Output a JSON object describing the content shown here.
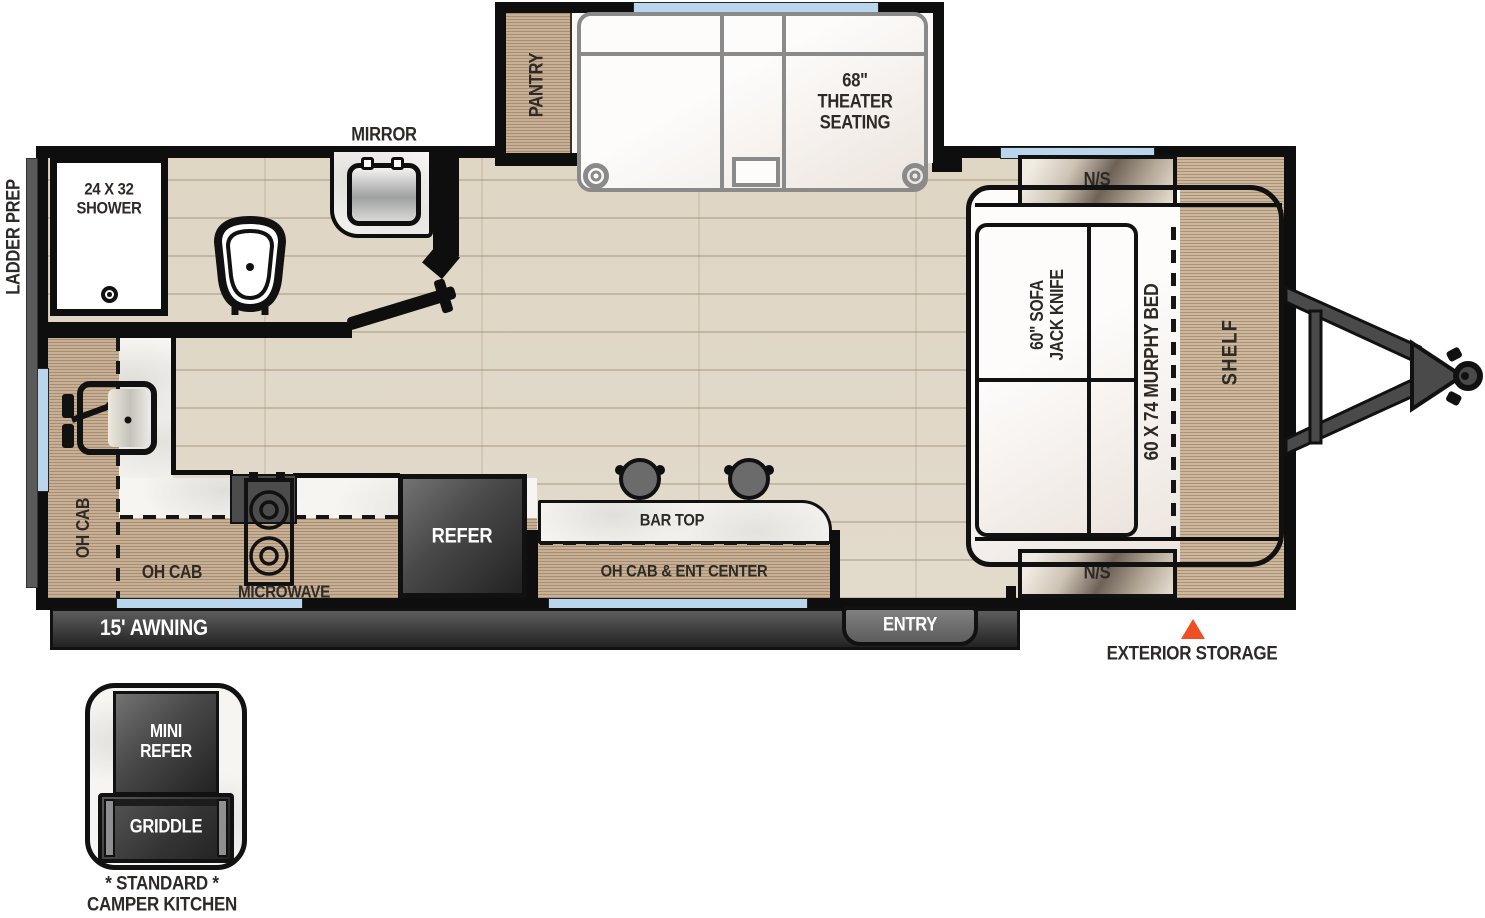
{
  "colors": {
    "wall": "#0E0E0E",
    "floor_wood": "#E2DACB",
    "cabinet_wood": "#C8B096",
    "marble": "#F6F5F2",
    "window_blue": "#B9D6EC",
    "dark_gray": "#4A4A4A",
    "accent_orange": "#F04E23"
  },
  "exterior": {
    "ladder_prep_label": "LADDER PREP",
    "awning_label": "15' AWNING",
    "entry_label": "ENTRY",
    "exterior_storage_label": "EXTERIOR STORAGE"
  },
  "bathroom": {
    "mirror_label": "MIRROR",
    "shower_label": "24 X 32\nSHOWER"
  },
  "slide_out": {
    "pantry_label": "PANTRY",
    "theater_label": "68\"\nTHEATER\nSEATING"
  },
  "kitchen": {
    "oh_cab_left_label": "OH CAB",
    "oh_cab_bottom_label": "OH CAB",
    "microwave_label": "MICROWAVE",
    "refrigerator_label": "REFER",
    "bar_top_label": "BAR TOP",
    "ent_center_label": "OH CAB & ENT CENTER"
  },
  "bedroom": {
    "nightstand_top_label": "N/S",
    "nightstand_bottom_label": "N/S",
    "sofa_label": "60\" SOFA\nJACK KNIFE",
    "murphy_bed_label": "60 X 74 MURPHY BED",
    "shelf_label": "SHELF"
  },
  "camper_kitchen": {
    "mini_refer_label": "MINI\nREFER",
    "griddle_label": "GRIDDLE",
    "caption": "* STANDARD *\nCAMPER KITCHEN"
  }
}
